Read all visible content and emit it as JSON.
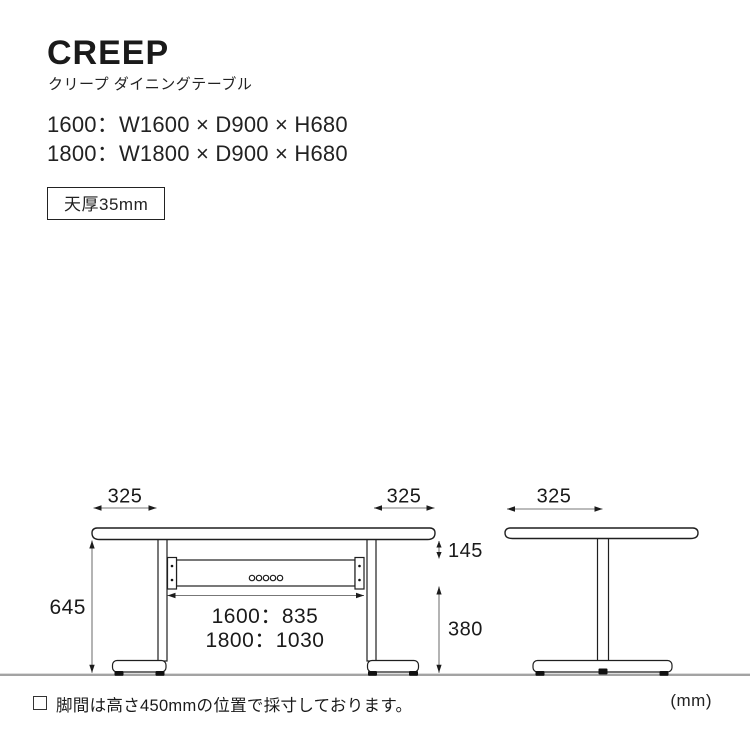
{
  "header": {
    "title": "CREEP",
    "subtitle": "クリープ ダイニングテーブル",
    "specs": [
      "1600：W1600 × D900 × H680",
      "1800：W1800 × D900 × H680"
    ],
    "badge": "天厚35mm"
  },
  "diagram": {
    "front": {
      "overhang_left": "325",
      "overhang_right": "325",
      "height_floor_to_top": "645",
      "top_to_stretcher": "145",
      "floor_to_stretcher": "380",
      "leg_span_1600": "1600：835",
      "leg_span_1800": "1800：1030"
    },
    "side": {
      "overhang": "325"
    },
    "unit": "(mm)"
  },
  "footnote": {
    "text": "脚間は高さ450mmの位置で採寸しております。"
  },
  "colors": {
    "line": "#1f1f1f",
    "dimension_line": "#777777",
    "ground": "#a3a3a3",
    "text": "#1a1a1a"
  }
}
